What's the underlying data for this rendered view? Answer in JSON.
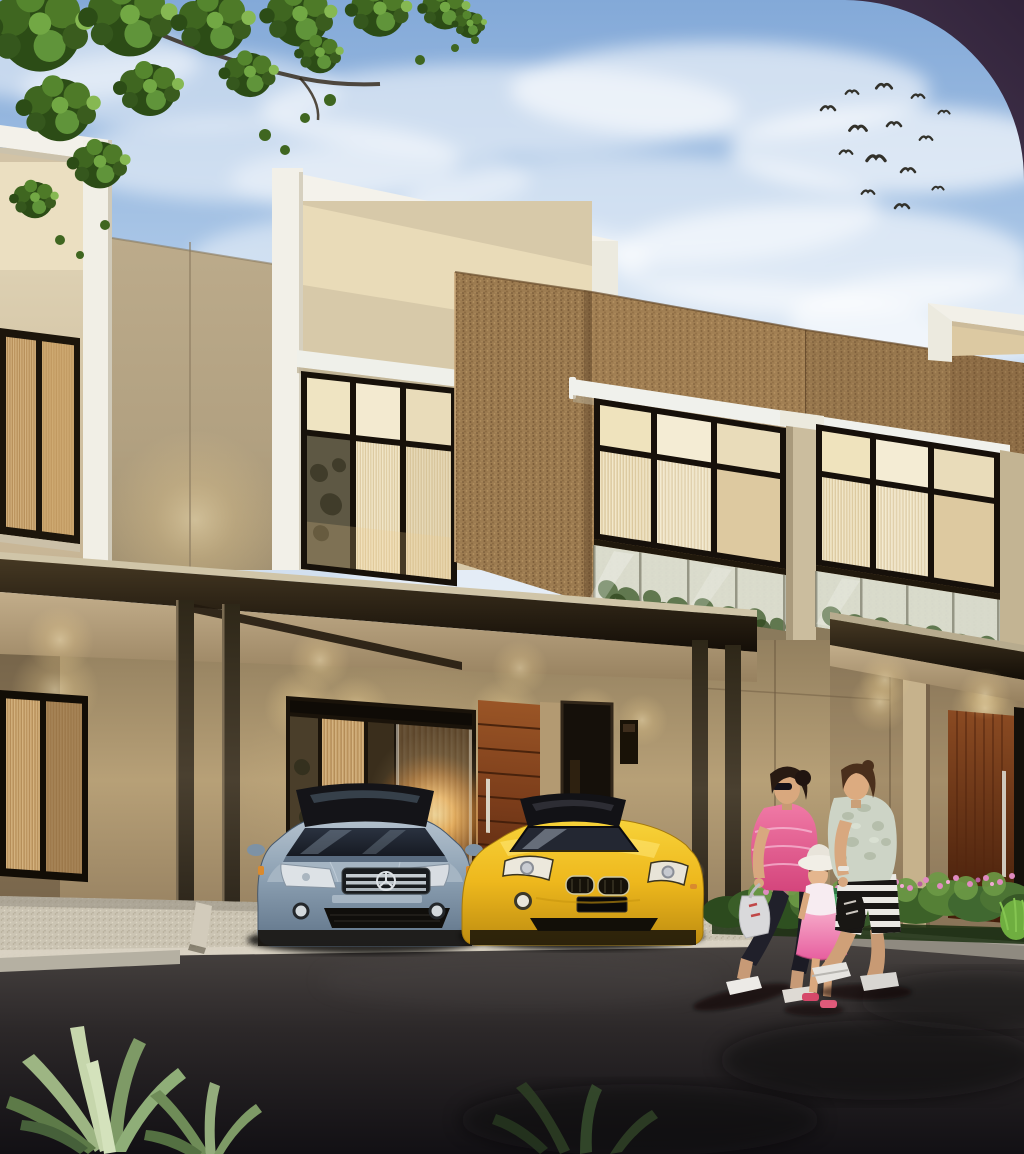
{
  "image": {
    "kind": "3d-architectural-rendering",
    "subject": "Modern two-storey townhouse row at dusk with carport, two parked cars and a family of three walking past",
    "lighting": "dusk sky with warm interior and downlight glow",
    "corner_style": "large rounded top-right corner over dark purple backdrop"
  },
  "palette": {
    "sky_blue": "#a8c5e6",
    "cloud_white": "#f2f7fc",
    "backdrop_purple": "#3f3048",
    "wall_beige": "#d5c6a6",
    "wall_cream": "#ece0c2",
    "trim_white": "#f2f0e8",
    "brick_brown": "#9c7b50",
    "canopy_dark": "#2a2114",
    "timber_door": "#7a3c1a",
    "road_asphalt": "#211d1f",
    "concrete_light": "#cbc4b3",
    "foliage_green": "#4e7a28",
    "shrub_green": "#57803a",
    "flower_pink": "#d77bb4",
    "sedan_silver_blue": "#8ea2b4",
    "roadster_yellow": "#eeb81d",
    "woman_top_pink": "#e85a8a",
    "girl_dress_pink": "#e75f9f",
    "boy_shorts_stripe": "#191715"
  },
  "objects": {
    "birds_in_flock": 14,
    "cars": [
      {
        "label": "silver-blue sedan, front view, chrome three-bar grille with star emblem",
        "position": "left carport bay"
      },
      {
        "label": "yellow roadster convertible, black soft top, twin kidney grilles",
        "position": "right carport bay"
      }
    ],
    "people": [
      {
        "label": "woman in pink top, dark capri pants, sunglasses, carrying light bag"
      },
      {
        "label": "girl in white sun hat and pink dress holding green bottle"
      },
      {
        "label": "boy in pale camo t-shirt and black-white striped shorts"
      }
    ],
    "landscaping": [
      "overhanging tree canopy top-left",
      "flowering shrub bed with pink blooms",
      "spiky agave plants bottom-left"
    ],
    "building_features": [
      "white parapet frames",
      "textured brick feature walls",
      "glass balustrade balconies",
      "curtained lit windows",
      "flat carport canopy on dark posts",
      "timber entry doors with steel pulls",
      "recessed downlights"
    ]
  }
}
